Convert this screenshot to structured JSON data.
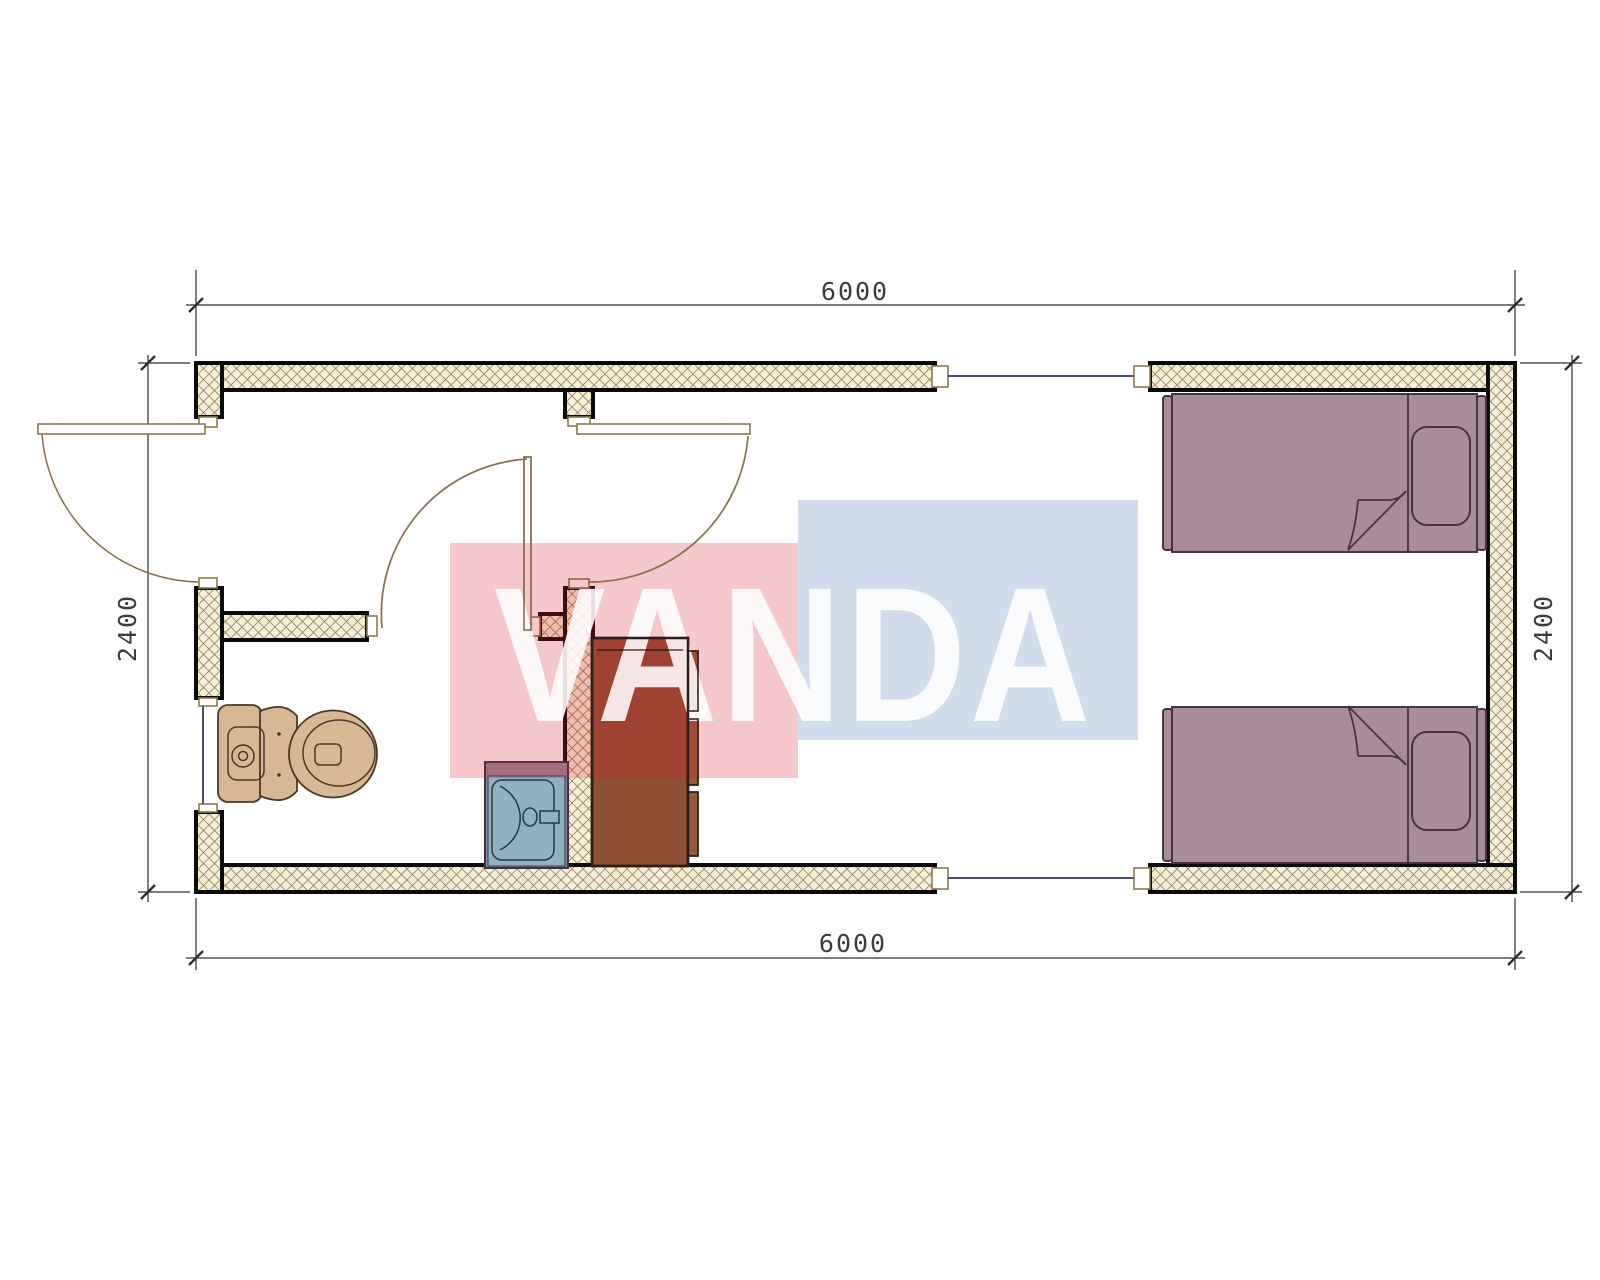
{
  "watermark": {
    "text": "VANDA",
    "red_block_color": "#ed4956",
    "blue_block_color": "#ccd9ec"
  },
  "dimensions": {
    "top": "6000",
    "bottom": "6000",
    "left": "2400",
    "right": "2400"
  },
  "fixtures": {
    "toilet": "toilet",
    "sink": "sink-vanity",
    "wardrobe": "wardrobe-cabinet",
    "bed_top": "single-bed",
    "bed_bottom": "single-bed"
  },
  "colors": {
    "wall_line": "#0a0a0a",
    "hatch_line": "#9b8a58",
    "hatch_bg": "#f6efdc",
    "cap_line": "#8a7b4c",
    "dim_line": "#2e2e2e",
    "dim_text": "#3c3c3c",
    "door_line": "#8a7550",
    "window_line": "#4a4e72",
    "toilet_fill": "#d8b795",
    "toilet_line": "#4a3826",
    "sink_counter": "#96879e",
    "sink_basin": "#8fb2c1",
    "sink_line": "#24394a",
    "wardrobe_fill": "#8f4f35",
    "wardrobe_panel": "#935a3e",
    "wardrobe_line": "#2e1d16",
    "bed_fill": "#a78d9a",
    "bed_line": "#463440",
    "wm_red": "rgba(214,26,38,0.24)",
    "wm_blue": "rgba(25,80,160,0.20)",
    "wm_text": "rgba(255,255,255,0.87)"
  }
}
